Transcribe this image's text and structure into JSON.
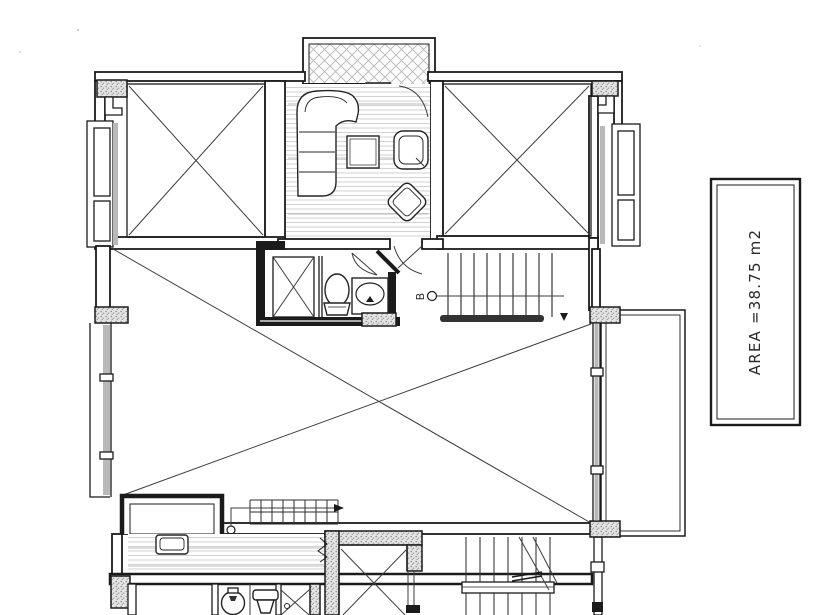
{
  "colors": {
    "ink": "#1b1b1b",
    "paper": "#ffffff",
    "glazing_gray": "#b9b9b9",
    "floor_hatch": "#cdcdcd",
    "stipple_bg": "#e4e4e4"
  },
  "area_label": {
    "text": "AREA =38.75 m2"
  },
  "section_marker": {
    "text": "B"
  }
}
